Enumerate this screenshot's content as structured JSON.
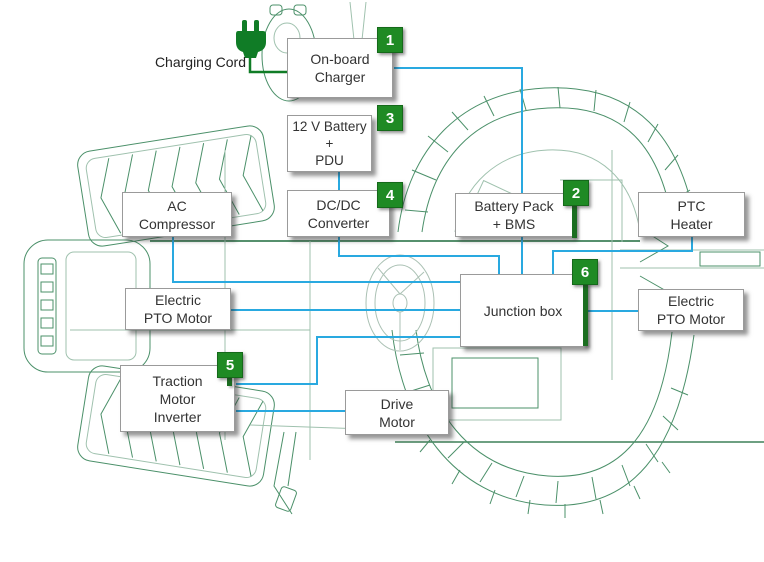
{
  "palette": {
    "badge_green": "#1f8a24",
    "connector_blue": "#29a9e0",
    "cord_green": "#107c26",
    "art_green": "#2c7d50",
    "text_color": "#333333"
  },
  "labels": {
    "charging_cord": "Charging Cord"
  },
  "components": [
    {
      "name": "on-board-charger",
      "badge": "1",
      "lines": [
        "On-board",
        "Charger"
      ]
    },
    {
      "name": "twelve-v-battery-pdu",
      "badge": "3",
      "lines": [
        "12 V Battery",
        "+",
        "PDU"
      ]
    },
    {
      "name": "dcdc-converter",
      "badge": "4",
      "lines": [
        "DC/DC",
        "Converter"
      ]
    },
    {
      "name": "battery-pack-bms",
      "badge": "2",
      "lines": [
        "Battery Pack",
        "+ BMS"
      ]
    },
    {
      "name": "ptc-heater",
      "badge": "",
      "lines": [
        "PTC",
        "Heater"
      ]
    },
    {
      "name": "ac-compressor",
      "badge": "",
      "lines": [
        "AC",
        "Compressor"
      ]
    },
    {
      "name": "electric-pto-motor-left",
      "badge": "",
      "lines": [
        "Electric",
        "PTO Motor"
      ]
    },
    {
      "name": "junction-box",
      "badge": "6",
      "lines": [
        "Junction box"
      ]
    },
    {
      "name": "electric-pto-motor-right",
      "badge": "",
      "lines": [
        "Electric",
        "PTO Motor"
      ]
    },
    {
      "name": "traction-motor-inverter",
      "badge": "5",
      "lines": [
        "Traction",
        "Motor",
        "Inverter"
      ]
    },
    {
      "name": "drive-motor",
      "badge": "",
      "lines": [
        "Drive",
        "Motor"
      ]
    }
  ],
  "connections": [
    {
      "from": "Charging Cord",
      "to": "On-board Charger"
    },
    {
      "from": "On-board Charger",
      "to": "Battery Pack + BMS"
    },
    {
      "from": "Battery Pack + BMS",
      "to": "Junction box"
    },
    {
      "from": "12 V Battery + PDU",
      "to": "DC/DC Converter"
    },
    {
      "from": "DC/DC Converter",
      "to": "Junction box"
    },
    {
      "from": "PTC Heater",
      "to": "Junction box"
    },
    {
      "from": "AC Compressor",
      "to": "Junction box"
    },
    {
      "from": "Electric PTO Motor (left)",
      "to": "Junction box"
    },
    {
      "from": "Junction box",
      "to": "Electric PTO Motor (right)"
    },
    {
      "from": "Junction box",
      "to": "Traction Motor Inverter"
    },
    {
      "from": "Traction Motor Inverter",
      "to": "Drive Motor"
    }
  ]
}
